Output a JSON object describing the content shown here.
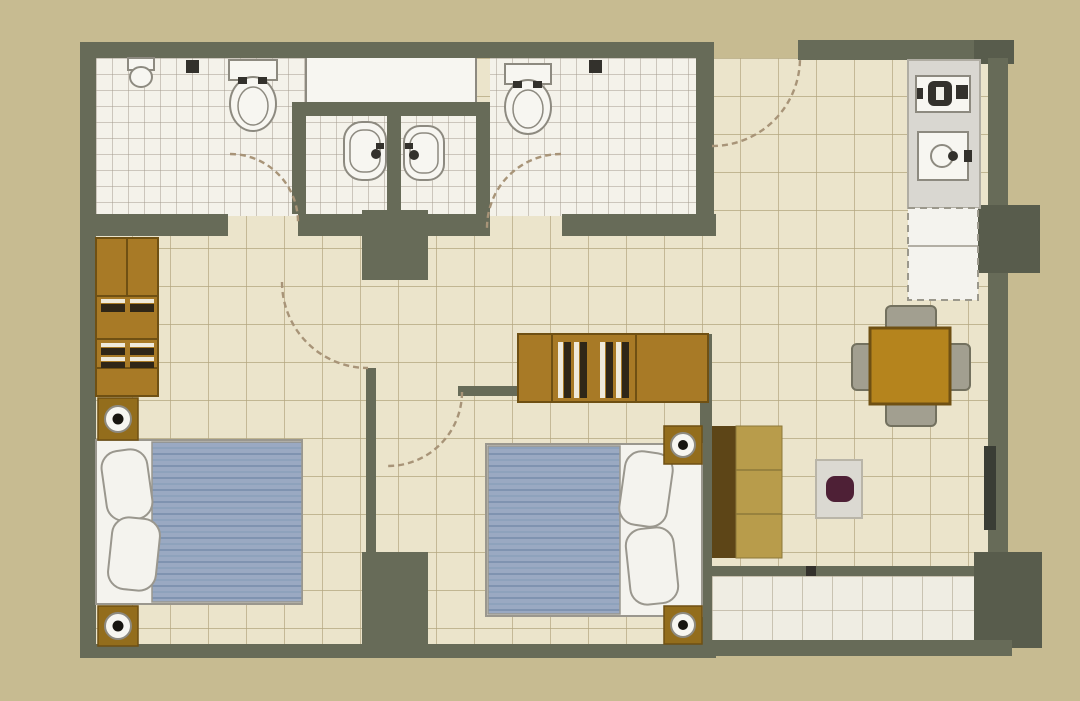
{
  "title": "two-bedroom-apartment-floor-plan",
  "palette": {
    "bg": "#c7bb91",
    "wall": "#676b58",
    "wallDark": "#585c4c",
    "floor": "#ebe4cb",
    "floorLine": "#b3a67f",
    "bathFloor": "#f4f2ea",
    "bathLine": "#a39b8d",
    "balconyFloor": "#efede3",
    "balconyLine": "#b0a791",
    "white": "#f7f6f1",
    "fixtureStroke": "#8d8a80",
    "blanket": "#9aa9c2",
    "blanketStripe": "#8094b2",
    "bedBase": "#f4f3ee",
    "bedStroke": "#9a978e",
    "wood": "#a87a26",
    "woodDark": "#6f5013",
    "woodMark": "#2f2617",
    "nightstand": "#936d1c",
    "lampDot": "#181510",
    "sofaBack": "#5d4517",
    "sofaSeat": "#b89c4b",
    "table": "#b5841d",
    "chair": "#a29f90",
    "chairStroke": "#73715f",
    "rug": "#dbd9d2",
    "rugBlob": "#4e2036",
    "counter": "#d9d7d1",
    "dark": "#33312c",
    "windowBar": "#3a3d35",
    "arc": "#a89478"
  },
  "rooms": [
    {
      "name": "bathroom-1",
      "position": "top-left",
      "floor": "small-white-tiles",
      "fixtures": [
        "toilet",
        "mini-wash-basin",
        "wall-fitting",
        "inward-door-swing"
      ]
    },
    {
      "name": "vanity-alcove",
      "position": "top-center",
      "floor": "small-white-tiles",
      "fixtures": [
        "service-shaft-box",
        "pedestal-sink-left",
        "pedestal-sink-right",
        "dividing-wall"
      ]
    },
    {
      "name": "bathroom-2",
      "position": "top-middle",
      "floor": "small-white-tiles",
      "fixtures": [
        "toilet",
        "wall-fitting",
        "inward-door-swing"
      ]
    },
    {
      "name": "entry-hall",
      "position": "top-right-of-bath-2",
      "floor": "beige-tiles",
      "fixtures": [
        "entrance-door-swing"
      ]
    },
    {
      "name": "kitchen",
      "position": "right-top",
      "floor": "beige-tiles",
      "fixtures": [
        "counter-run",
        "cooktop",
        "kitchen-sink",
        "refrigerator-space-dashed"
      ]
    },
    {
      "name": "living-dining",
      "position": "right",
      "floor": "beige-tiles",
      "fixtures": [
        "sofa",
        "coffee-table-rug",
        "dining-table",
        "four-chairs",
        "window",
        "structural-columns"
      ]
    },
    {
      "name": "bedroom-1",
      "position": "bottom-left",
      "floor": "beige-tiles",
      "fixtures": [
        "wardrobe-with-hanging-clothes",
        "double-bed-blue-blanket",
        "nightstand-with-lamp-top",
        "nightstand-with-lamp-bottom",
        "inward-door-swing"
      ]
    },
    {
      "name": "bedroom-2",
      "position": "bottom-center",
      "floor": "beige-tiles",
      "fixtures": [
        "wardrobe-with-hanging-clothes",
        "double-bed-blue-blanket",
        "nightstand-with-lamp-top",
        "nightstand-with-lamp-bottom",
        "inward-door-swing"
      ]
    },
    {
      "name": "balcony",
      "position": "bottom-right",
      "floor": "light-tiles",
      "fixtures": [
        "structural-column"
      ]
    }
  ]
}
